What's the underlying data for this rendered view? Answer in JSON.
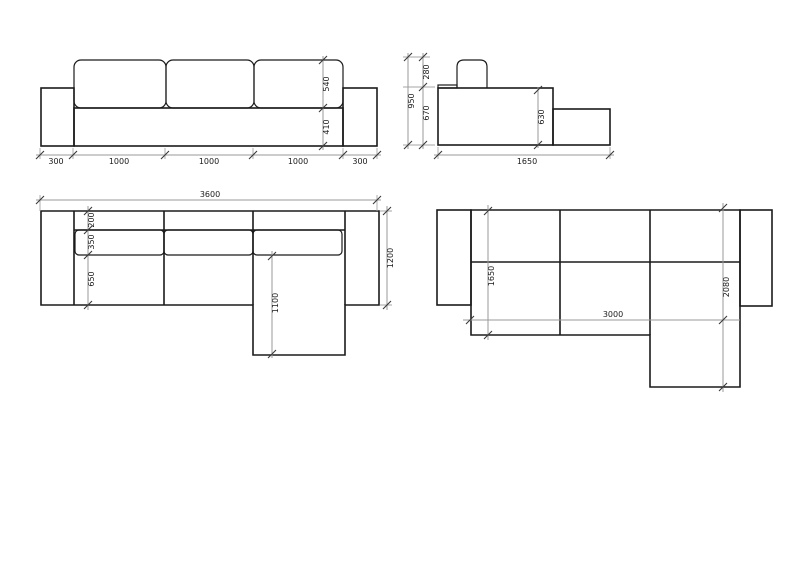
{
  "meta": {
    "drawing_type": "sectional-sofa-technical-drawing",
    "background_color": "#ffffff",
    "line_color": "#1b1b1b",
    "dimension_line_color": "#9a9a9a",
    "text_color": "#1a1a1a"
  },
  "views": {
    "front_elevation": {
      "bottom_segments": [
        "300",
        "1000",
        "1000",
        "1000",
        "300"
      ],
      "back_cushion_height": "540",
      "seat_height": "410"
    },
    "side_elevation": {
      "backrest_above_seat": "280",
      "total_height": "950",
      "seat_to_floor": "670",
      "right_body_height": "630",
      "total_depth": "1650"
    },
    "plan": {
      "total_width": "3600",
      "back_depth": "200",
      "cushion_depth": "350",
      "seat_depth": "650",
      "chaise_extension": "1100",
      "total_depth": "1200"
    },
    "module_plan": {
      "inner_depth": "1650",
      "inner_width": "3000",
      "total_depth": "2080"
    }
  }
}
